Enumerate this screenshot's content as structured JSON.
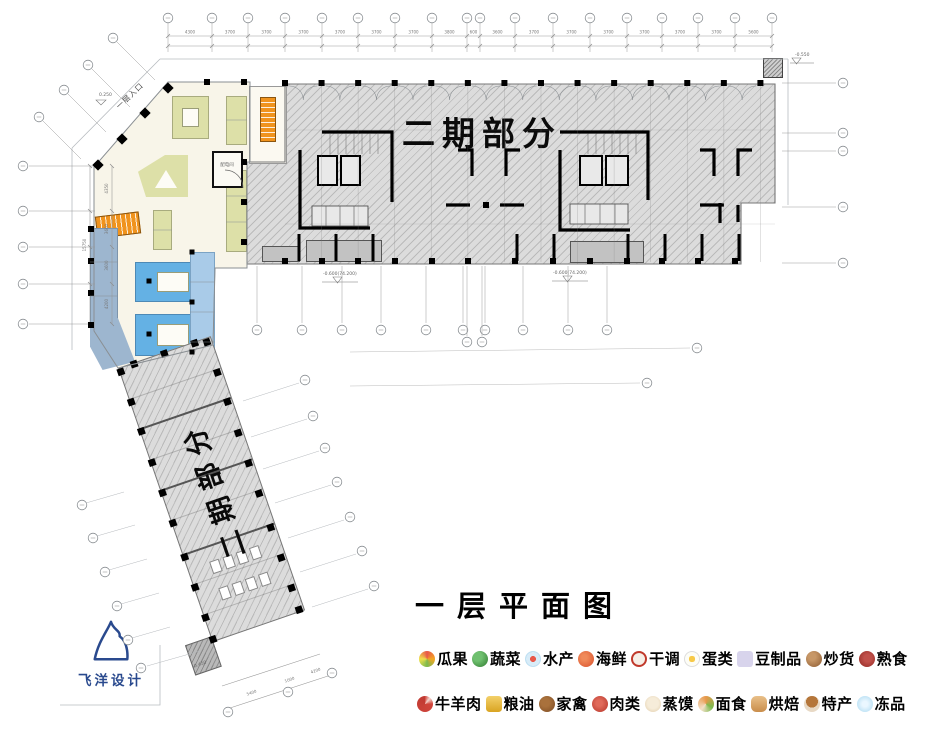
{
  "plan": {
    "block_label": "二期部分",
    "strip_label": "二期部分",
    "entrance_label": "一层入口",
    "electrical_room_label": "配电间",
    "slope_label": "0.250",
    "elev_block_left": "-0.600(74.200)",
    "elev_block_right": "-0.600(74.200)",
    "elev_top_right": "-0.550",
    "elev_strip_bottom": "-0.450"
  },
  "dimensions": {
    "top": [
      "4300",
      "3700",
      "3700",
      "3700",
      "3700",
      "3700",
      "3700",
      "3800",
      "600",
      "3600",
      "3700",
      "3700",
      "3700",
      "3700",
      "3700",
      "3700",
      "5600"
    ],
    "left": [
      "4350",
      "3600",
      "3600",
      "4200"
    ],
    "left_total": "15750",
    "strip_bottom": [
      "5400",
      "1000",
      "4200"
    ]
  },
  "title": "一层平面图",
  "legend": {
    "row1": [
      {
        "icon": "fruit",
        "label": "瓜果"
      },
      {
        "icon": "vegetable",
        "label": "蔬菜"
      },
      {
        "icon": "aquatic",
        "label": "水产"
      },
      {
        "icon": "seafood",
        "label": "海鲜"
      },
      {
        "icon": "dry-seasoning",
        "label": "干调"
      },
      {
        "icon": "egg",
        "label": "蛋类"
      },
      {
        "icon": "tofu",
        "label": "豆制品"
      },
      {
        "icon": "roasted-nuts",
        "label": "炒货"
      },
      {
        "icon": "cooked-food",
        "label": "熟食"
      }
    ],
    "row2": [
      {
        "icon": "beef-mutton",
        "label": "牛羊肉"
      },
      {
        "icon": "grain-oil",
        "label": "粮油"
      },
      {
        "icon": "poultry",
        "label": "家禽"
      },
      {
        "icon": "meat",
        "label": "肉类"
      },
      {
        "icon": "steamed-bun",
        "label": "蒸馍"
      },
      {
        "icon": "noodles",
        "label": "面食"
      },
      {
        "icon": "bakery",
        "label": "烘焙"
      },
      {
        "icon": "specialty",
        "label": "特产"
      },
      {
        "icon": "frozen",
        "label": "冻品"
      }
    ]
  },
  "logo": {
    "text": "飞洋设计"
  },
  "colors": {
    "phase2_hatch": "#dcdcdc",
    "stall_olive": "#dde0a8",
    "stall_blue": "#64b1e4",
    "stall_lightblue": "#a9cbe8",
    "stair_orange": "#f0931d",
    "floor_cream": "#f8f5e9",
    "logo_blue": "#2a4a8e"
  }
}
